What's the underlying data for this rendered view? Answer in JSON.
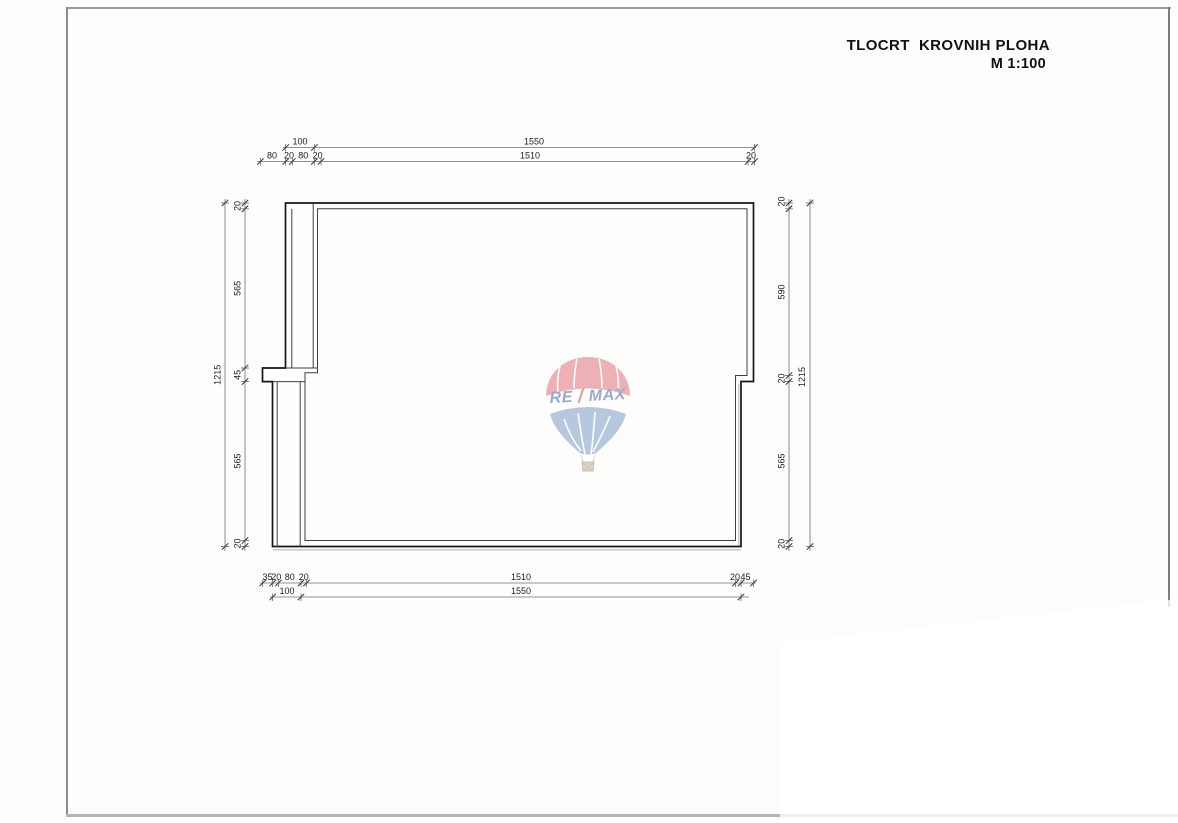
{
  "title": {
    "line1": "TLOCRT  KROVNIH PLOHA",
    "line2": "M 1:100"
  },
  "dims": {
    "top_row1": [
      "100",
      "1550"
    ],
    "top_row2": [
      "80",
      "20",
      "80",
      "20",
      "1510",
      "20"
    ],
    "bottom_row1": [
      "35",
      "20",
      "80",
      "20",
      "1510",
      "20",
      "45"
    ],
    "bottom_row2": [
      "100",
      "1550"
    ],
    "left_outer": "1215",
    "left_inner": [
      "20",
      "565",
      "45",
      "565",
      "20"
    ],
    "right_inner": [
      "20",
      "590",
      "20",
      "565",
      "20"
    ],
    "right_outer": "1215"
  },
  "watermark": {
    "brand_re": "RE",
    "brand_slash": "/",
    "brand_max": "MAX",
    "colors": {
      "red": "#ecaab0",
      "blue": "#b0c4dd",
      "text_blue": "#93a2c6",
      "slash_red": "#dc9ba0",
      "basket": "#d9d2c2",
      "basket_line": "#b9b09d"
    }
  }
}
